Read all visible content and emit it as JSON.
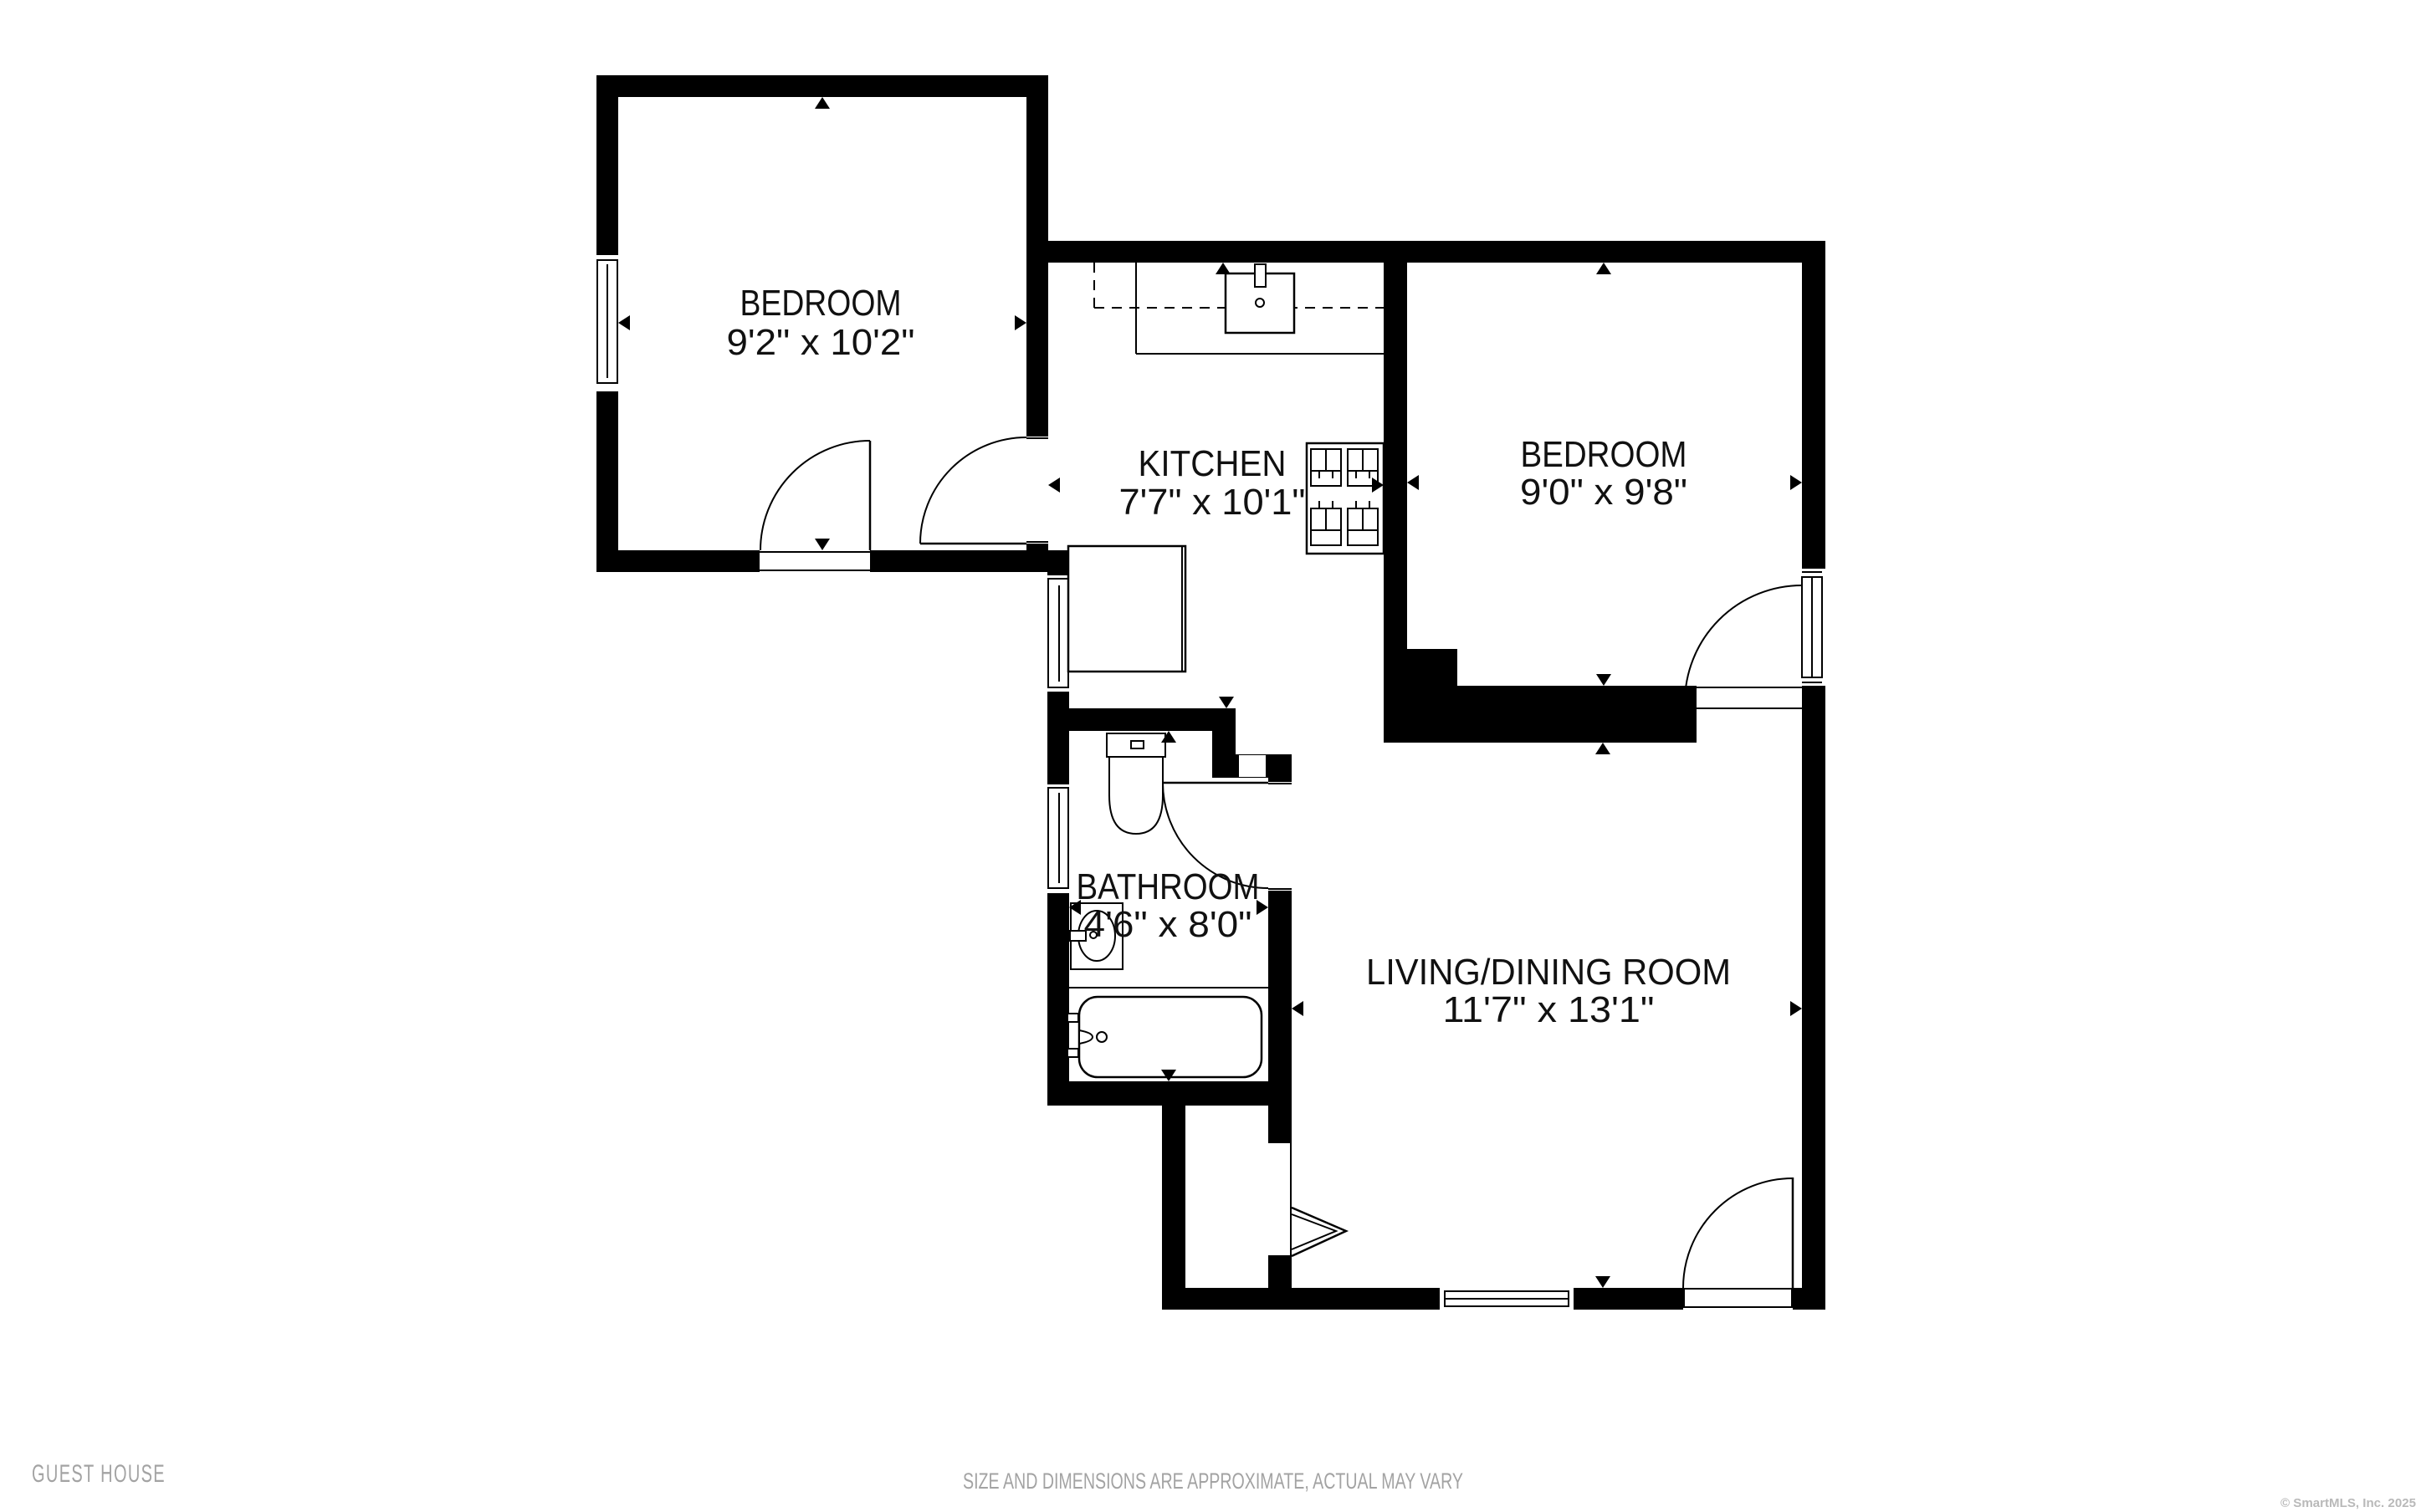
{
  "plan": {
    "rooms": [
      {
        "name": "BEDROOM",
        "dims": "9'2\" x 10'2\""
      },
      {
        "name": "KITCHEN",
        "dims": "7'7\" x 10'1\""
      },
      {
        "name": "BEDROOM",
        "dims": "9'0\" x 9'8\""
      },
      {
        "name": "BATHROOM",
        "dims": "4'6\" x 8'0\""
      },
      {
        "name": "LIVING/DINING ROOM",
        "dims": "11'7\" x 13'1\""
      }
    ],
    "fixtures": [
      "toilet-icon",
      "sink-icon",
      "bathtub-icon",
      "stove-icon",
      "kitchen-sink-icon",
      "counter-icon"
    ]
  },
  "footer": {
    "property_label": "GUEST HOUSE",
    "disclaimer": "SIZE AND DIMENSIONS ARE APPROXIMATE, ACTUAL MAY VARY",
    "copyright": "© SmartMLS, Inc.  2025"
  },
  "colors": {
    "walls": "#000000",
    "labels": "#111111",
    "footer_text": "#a3a3a3",
    "copyright_text": "#b9b9b9",
    "background": "#ffffff"
  }
}
